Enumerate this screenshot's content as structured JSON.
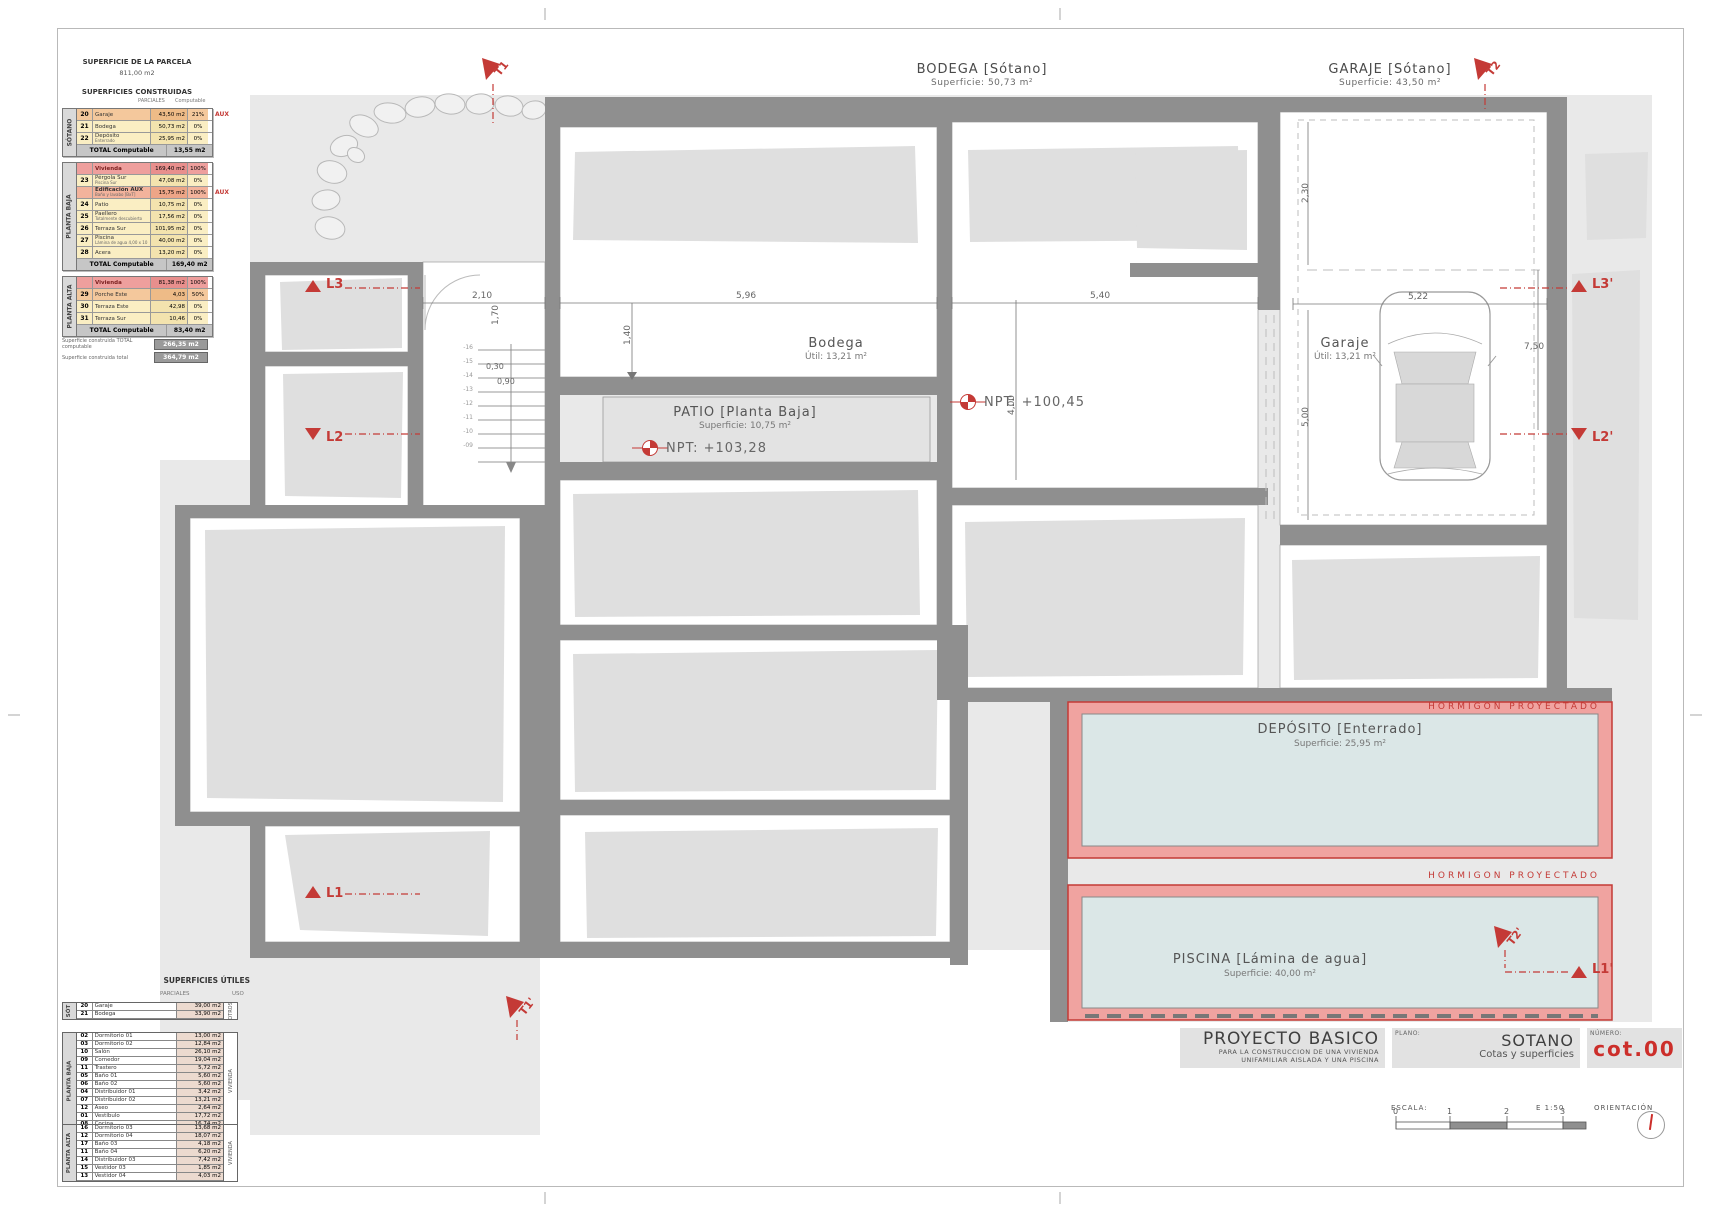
{
  "colors": {
    "accent_red": "#c43a36",
    "wall_gray": "#8f8f8f",
    "canvas_gray": "#e9e9e9",
    "pool_blue": "#dbe7e7",
    "pink_band": "#f0a3a0"
  },
  "parcel": {
    "title": "SUPERFICIE DE LA PARCELA",
    "value": "811,00 m2",
    "built_title": "SUPERFICIES CONSTRUIDAS",
    "sub1": "PARCIALES",
    "sub2": "Computable"
  },
  "tables": {
    "sotano": {
      "side": "SÓTANO",
      "total_label": "TOTAL Computable",
      "total_value": "13,55 m2",
      "rows": [
        {
          "num": "20",
          "label": "Garaje",
          "sub": "",
          "val": "43,50 m2",
          "pct": "21%",
          "aux": "AUX",
          "cls": "orange"
        },
        {
          "num": "21",
          "label": "Bodega",
          "sub": "",
          "val": "50,73 m2",
          "pct": "0%",
          "aux": "",
          "cls": "yellow"
        },
        {
          "num": "22",
          "label": "Depósito",
          "sub": "Enterrado",
          "val": "25,95 m2",
          "pct": "0%",
          "aux": "",
          "cls": "yellow"
        }
      ]
    },
    "planta_baja": {
      "side": "PLANTA BAJA",
      "total_label": "TOTAL Computable",
      "total_value": "169,40 m2",
      "rows": [
        {
          "num": "",
          "label": "Vivienda",
          "sub": "",
          "val": "169,40 m2",
          "pct": "100%",
          "aux": "",
          "cls": "red"
        },
        {
          "num": "23",
          "label": "Pérgola Sur",
          "sub": "Piscina Sur",
          "val": "47,08 m2",
          "pct": "0%",
          "aux": "",
          "cls": "yellow"
        },
        {
          "num": "",
          "label": "Edificación AUX",
          "sub": "Baño y lavabo [BxT]",
          "val": "15,75 m2",
          "pct": "100%",
          "aux": "AUX",
          "cls": "salmon"
        },
        {
          "num": "24",
          "label": "Patio",
          "sub": "",
          "val": "10,75 m2",
          "pct": "0%",
          "aux": "",
          "cls": "yellow"
        },
        {
          "num": "25",
          "label": "Paellero",
          "sub": "Totalmente descubierto",
          "val": "17,56 m2",
          "pct": "0%",
          "aux": "",
          "cls": "yellow"
        },
        {
          "num": "26",
          "label": "Terraza Sur",
          "sub": "",
          "val": "101,95 m2",
          "pct": "0%",
          "aux": "",
          "cls": "yellow"
        },
        {
          "num": "27",
          "label": "Piscina",
          "sub": "Lámina de agua 4,00 x 10",
          "val": "40,00 m2",
          "pct": "0%",
          "aux": "",
          "cls": "yellow"
        },
        {
          "num": "28",
          "label": "Acera",
          "sub": "",
          "val": "13,20 m2",
          "pct": "0%",
          "aux": "",
          "cls": "yellow"
        }
      ]
    },
    "planta_alta": {
      "side": "PLANTA ALTA",
      "total_label": "TOTAL Computable",
      "total_value": "83,40 m2",
      "rows": [
        {
          "num": "",
          "label": "Vivienda",
          "sub": "",
          "val": "81,38 m2",
          "pct": "100%",
          "aux": "",
          "cls": "red"
        },
        {
          "num": "29",
          "label": "Porche Este",
          "sub": "",
          "val": "4,03",
          "pct": "50%",
          "aux": "",
          "cls": "orange"
        },
        {
          "num": "30",
          "label": "Terraza Este",
          "sub": "",
          "val": "42,98",
          "pct": "0%",
          "aux": "",
          "cls": "yellow"
        },
        {
          "num": "31",
          "label": "Terraza Sur",
          "sub": "",
          "val": "10,46",
          "pct": "0%",
          "aux": "",
          "cls": "yellow"
        }
      ]
    },
    "summary": [
      {
        "label": "Superficie construida TOTAL computable",
        "value": "266,35 m2"
      },
      {
        "label": "Superficie construida total",
        "value": "364,79 m2"
      }
    ]
  },
  "utiles": {
    "title": "SUPERFICIES ÚTILES",
    "sub1": "PARCIALES",
    "sub2": "USO",
    "sot": {
      "side": "SÓT",
      "uso": "OTROS",
      "rows": [
        {
          "num": "20",
          "label": "Garaje",
          "val": "39,00 m2"
        },
        {
          "num": "21",
          "label": "Bodega",
          "val": "33,90 m2"
        }
      ]
    },
    "pb": {
      "side": "PLANTA BAJA",
      "uso": "VIVIENDA",
      "rows": [
        {
          "num": "02",
          "label": "Dormitorio 01",
          "val": "13,00 m2"
        },
        {
          "num": "03",
          "label": "Dormitorio 02",
          "val": "12,84 m2"
        },
        {
          "num": "10",
          "label": "Salón",
          "val": "26,10 m2"
        },
        {
          "num": "09",
          "label": "Comedor",
          "val": "19,04 m2"
        },
        {
          "num": "11",
          "label": "Trastero",
          "val": "5,72 m2"
        },
        {
          "num": "05",
          "label": "Baño 01",
          "val": "5,60 m2"
        },
        {
          "num": "06",
          "label": "Baño 02",
          "val": "5,60 m2"
        },
        {
          "num": "04",
          "label": "Distribuidor 01",
          "val": "3,42 m2"
        },
        {
          "num": "07",
          "label": "Distribuidor 02",
          "val": "13,21 m2"
        },
        {
          "num": "12",
          "label": "Aseo",
          "val": "2,64 m2"
        },
        {
          "num": "01",
          "label": "Vestíbulo",
          "val": "17,72 m2"
        },
        {
          "num": "08",
          "label": "Cocina",
          "val": "16,74 m2"
        }
      ]
    },
    "pa": {
      "side": "PLANTA ALTA",
      "uso": "VIVIENDA",
      "rows": [
        {
          "num": "16",
          "label": "Dormitorio 03",
          "val": "13,68 m2"
        },
        {
          "num": "12",
          "label": "Dormitorio 04",
          "val": "18,07 m2"
        },
        {
          "num": "17",
          "label": "Baño 03",
          "val": "4,18 m2"
        },
        {
          "num": "11",
          "label": "Baño 04",
          "val": "6,20 m2"
        },
        {
          "num": "14",
          "label": "Distribuidor 03",
          "val": "7,42 m2"
        },
        {
          "num": "15",
          "label": "Vestidor 03",
          "val": "1,85 m2"
        },
        {
          "num": "13",
          "label": "Vestidor 04",
          "val": "4,03 m2"
        }
      ]
    }
  },
  "plan": {
    "bodega_zone_title": "BODEGA [Sótano]",
    "bodega_zone_sub": "Superficie: 50,73 m²",
    "garaje_zone_title": "GARAJE [Sótano]",
    "garaje_zone_sub": "Superficie: 43,50 m²",
    "bodega_room": "Bodega",
    "bodega_util": "Útil: 13,21 m²",
    "garaje_room": "Garaje",
    "garaje_util": "Útil: 13,21 m²",
    "patio_title": "PATIO [Planta Baja]",
    "patio_sub": "Superficie: 10,75 m²",
    "deposito_title": "DEPÓSITO  [Enterrado]",
    "deposito_sub": "Superficie: 25,95 m²",
    "piscina_title": "PISCINA [Lámina de agua]",
    "piscina_sub": "Superficie: 40,00 m²",
    "hormigon": "HORMIGON  PROYECTADO",
    "npt1": "NPT:  +103,28",
    "npt2": "NPT:  +100,45",
    "dims": {
      "d210": "2,10",
      "d596": "5,96",
      "d540": "5,40",
      "d522": "5,22",
      "d230": "2,30",
      "d500": "5,00",
      "d750": "7,50",
      "d140": "1,40",
      "d170": "1,70",
      "d030": "0,30",
      "d090": "0,90",
      "d400": "4,00"
    },
    "stairs": [
      "-16",
      "-15",
      "-14",
      "-13",
      "-12",
      "-11",
      "-10",
      "-09"
    ],
    "markers": {
      "l1": "L1",
      "l2": "L2",
      "l3": "L3",
      "l1p": "L1'",
      "l2p": "L2'",
      "l3p": "L3'",
      "t1": "T1",
      "t2": "T2",
      "t1p": "T1'",
      "t2p": "T2'"
    }
  },
  "titleblock": {
    "project_title": "PROYECTO BASICO",
    "project_sub1": "PARA LA CONSTRUCCION DE UNA VIVIENDA",
    "project_sub2": "UNIFAMILIAR AISLADA Y UNA PISCINA",
    "plano_label": "PLANO:",
    "plano_title": "SOTANO",
    "plano_sub": "Cotas y superficies",
    "numero_label": "NÚMERO:",
    "numero_value": "cot.00",
    "escala_label": "ESCALA:",
    "escala_value": "E  1:50",
    "escala_ticks": [
      "0",
      "1",
      "2",
      "3"
    ],
    "orientacion_label": "ORIENTACIÓN"
  }
}
